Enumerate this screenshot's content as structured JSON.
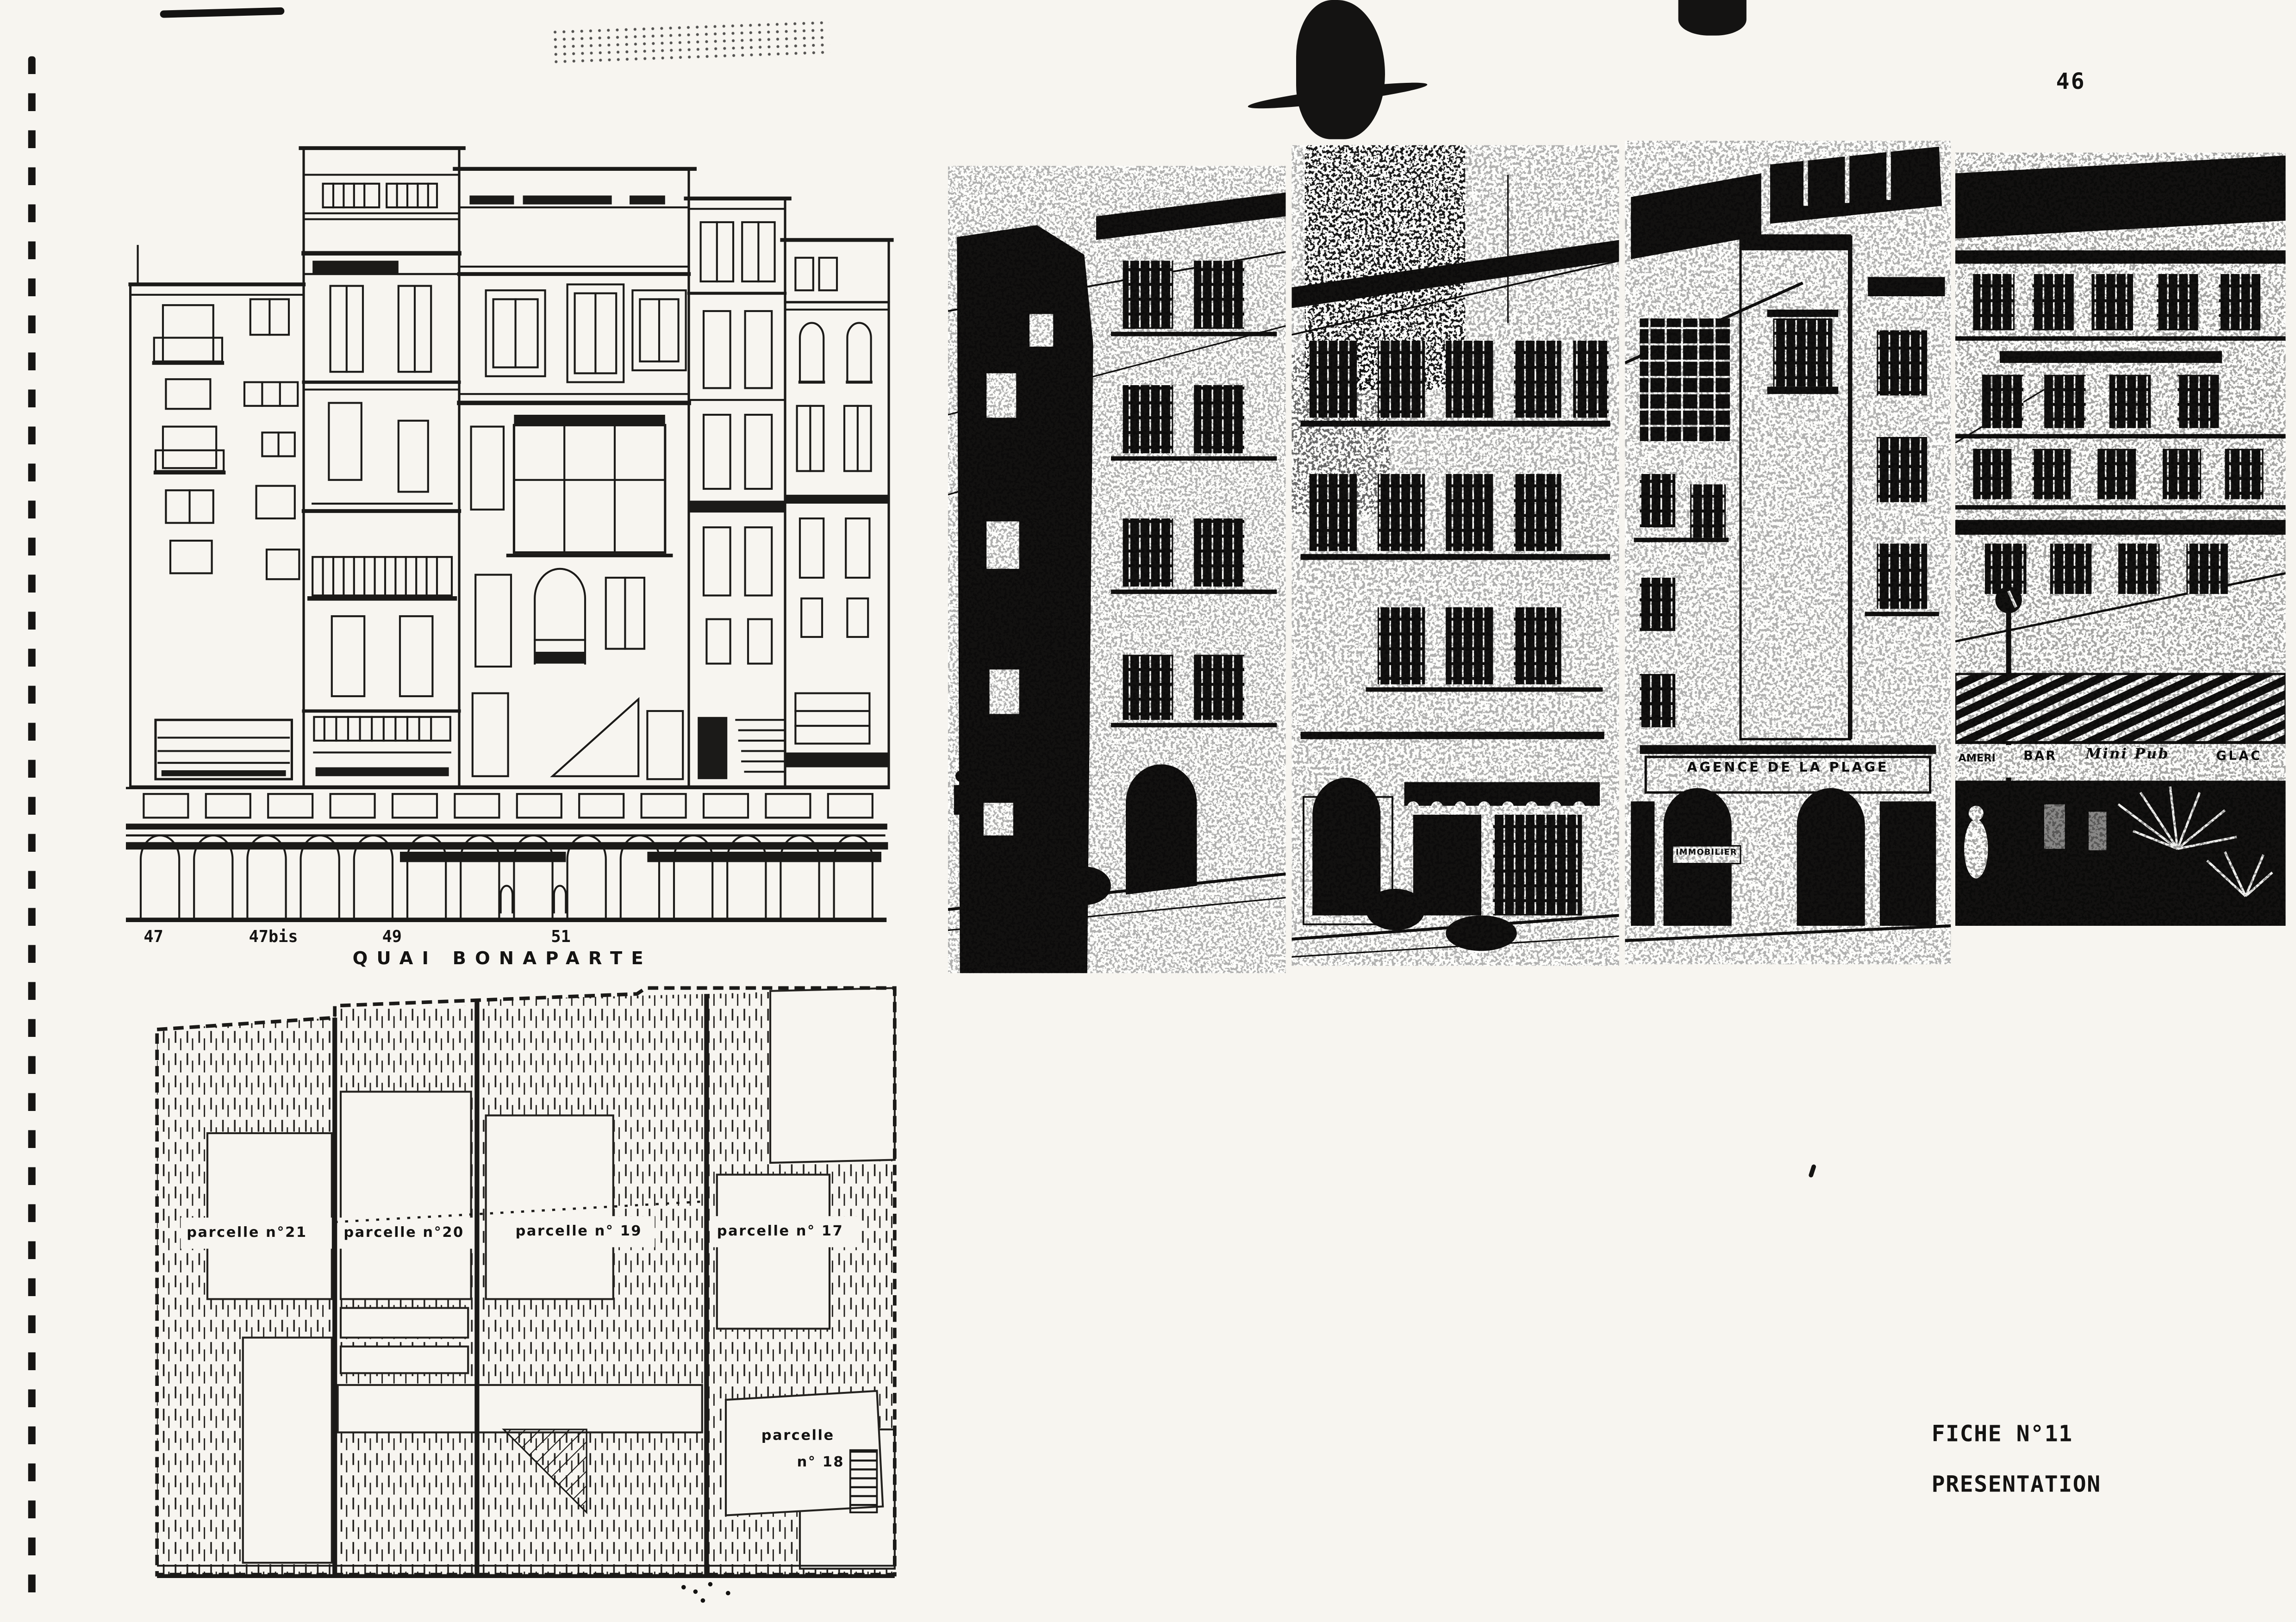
{
  "page": {
    "number": "46"
  },
  "elevation": {
    "address_labels": [
      "47",
      "47bis",
      "49",
      "51"
    ],
    "street_label": "QUAI BONAPARTE"
  },
  "photos": {
    "signs": {
      "agence": "AGENCE DE LA PLAGE",
      "immobilier": "IMMOBILIER",
      "amer": "AMERI",
      "bar": "BAR",
      "script": "Mini Pub",
      "glaces": "GLAC"
    }
  },
  "parcel_plan": {
    "labels": [
      {
        "text": "parcelle n°21"
      },
      {
        "text": "parcelle n°20"
      },
      {
        "text": "parcelle n° 19"
      },
      {
        "text": "parcelle n° 17"
      }
    ],
    "label_18_line1": "parcelle",
    "label_18_line2": "n° 18"
  },
  "fiche": {
    "line1": "FICHE N°11",
    "line2": "PRESENTATION"
  }
}
